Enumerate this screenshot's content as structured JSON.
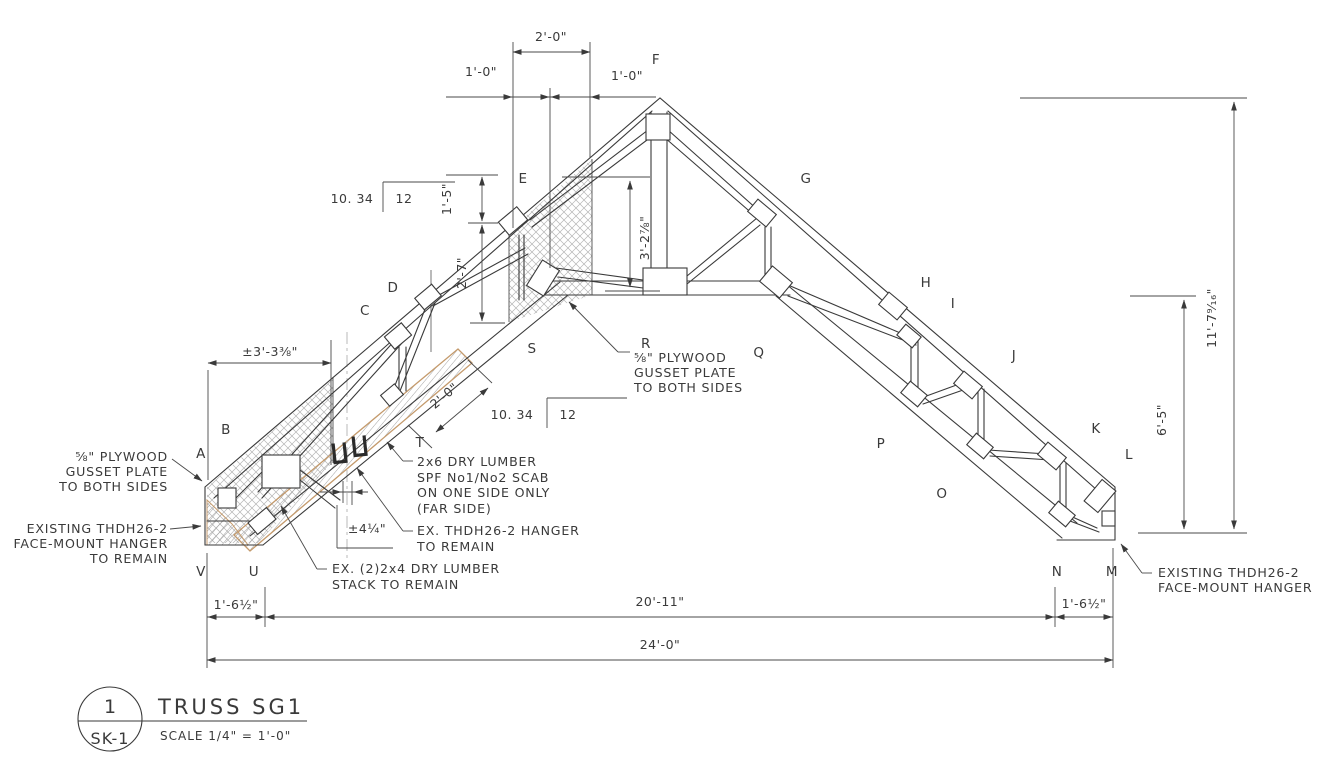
{
  "title_block": {
    "detail_number": "1",
    "sheet": "SK-1",
    "title": "TRUSS SG1",
    "scale": "SCALE  1/4\" = 1'-0\""
  },
  "labels": {
    "A": "A",
    "B": "B",
    "C": "C",
    "D": "D",
    "E": "E",
    "F": "F",
    "G": "G",
    "H": "H",
    "I": "I",
    "J": "J",
    "K": "K",
    "L": "L",
    "M": "M",
    "N": "N",
    "O": "O",
    "P": "P",
    "Q": "Q",
    "R": "R",
    "S": "S",
    "T": "T",
    "U": "U",
    "V": "V"
  },
  "slope": {
    "rise": "10. 34",
    "run": "12"
  },
  "dimensions": {
    "top_width": "2'-0\"",
    "top_left": "1'-0\"",
    "top_right": "1'-0\"",
    "peak_offset_1": "1'-5\"",
    "peak_offset_2": "2'-7\"",
    "king_height": "3'-2⅞\"",
    "gusset_extent": "±3'-3⅜\"",
    "scab_length": "2'-0\"",
    "stack_offset": "±4¼\"",
    "overall_height": "11'-7⁹⁄₁₆\"",
    "right_height": "6'-5\"",
    "left_overhang": "1'-6½\"",
    "span": "20'-11\"",
    "right_overhang": "1'-6½\"",
    "overall_span": "24'-0\""
  },
  "annotations": {
    "left_gusset": [
      "⅝\" PLYWOOD",
      "GUSSET PLATE",
      "TO BOTH SIDES"
    ],
    "left_hanger": [
      "EXISTING THDH26-2",
      "FACE-MOUNT HANGER",
      "TO REMAIN"
    ],
    "center_gusset": [
      "⅝\" PLYWOOD",
      "GUSSET PLATE",
      "TO BOTH SIDES"
    ],
    "scab": [
      "2x6 DRY LUMBER",
      "SPF No1/No2 SCAB",
      "ON ONE SIDE ONLY",
      "(FAR SIDE)"
    ],
    "ex_hanger": [
      "EX. THDH26-2 HANGER",
      "TO REMAIN"
    ],
    "stack": [
      "EX. (2)2x4 DRY LUMBER",
      "STACK TO REMAIN"
    ],
    "right_hanger": [
      "EXISTING THDH26-2",
      "FACE-MOUNT HANGER"
    ]
  },
  "colors": {
    "line": "#3a3a3a",
    "dim_line": "#4a4a4a",
    "hatch": "#b5b5b5",
    "scab_edge": "#c49a6c",
    "centerline": "#b8b8b8",
    "background": "#ffffff"
  }
}
